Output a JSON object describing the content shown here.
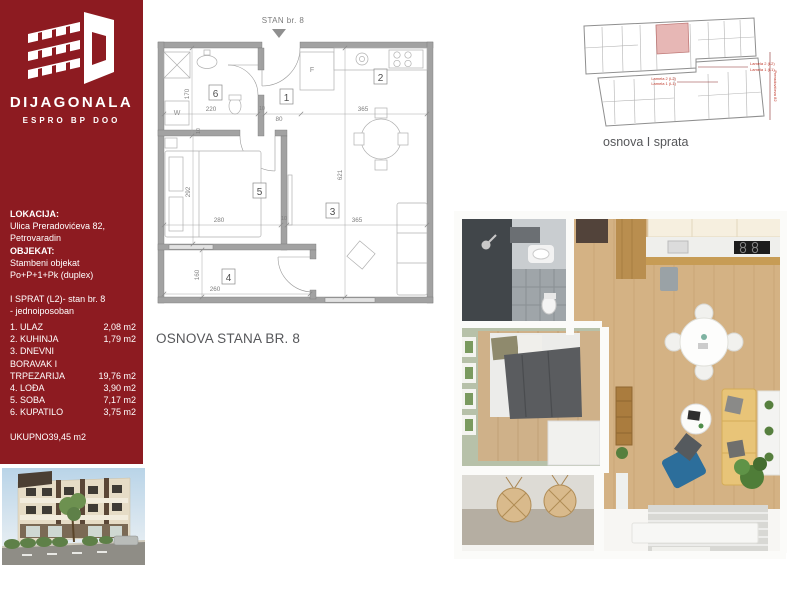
{
  "sidebar": {
    "brand": "DIJAGONALA",
    "brand_sub": "ESPRO BP DOO",
    "location_label": "LOKACIJA:",
    "location_line1": "Ulica Preradovićeva 82,",
    "location_line2": "Petrovaradin",
    "object_label": "OBJEKAT:",
    "object_line1": "Stambeni objekat",
    "object_line2": "Po+P+1+Pk (duplex)",
    "unit_line1": "I SPRAT (L2)- stan br. 8",
    "unit_line2": "- jednoiposoban",
    "rooms": [
      {
        "label": "1. ULAZ",
        "area": "2,08 m2"
      },
      {
        "label": "2. KUHINJA",
        "area": "1,79 m2"
      },
      {
        "label": "3. DNEVNI BORAVAK I TRPEZARIJA",
        "area": "19,76 m2"
      },
      {
        "label": "4. LOĐA",
        "area": "3,90 m2"
      },
      {
        "label": "5. SOBA",
        "area": "7,17 m2"
      },
      {
        "label": "6. KUPATILO",
        "area": "3,75 m2"
      }
    ],
    "total_label": "UKUPNO",
    "total_value": "39,45 m2"
  },
  "floor_plan": {
    "pointer_label": "STAN br. 8",
    "caption": "OSNOVA STANA BR. 8",
    "room_numbers": {
      "hall": "1",
      "kitchen": "2",
      "living": "3",
      "loggia": "4",
      "bedroom": "5",
      "bathroom": "6"
    },
    "fixtures": {
      "washer": "W",
      "fridge": "F"
    },
    "dims": {
      "bath_width": "220",
      "wall_a": "10",
      "entry_width": "80",
      "kitchen_width": "365",
      "bath_depth": "170",
      "bed_wall": "10",
      "bed_depth": "292",
      "bed_width": "280",
      "wall_b": "10",
      "living_width": "365",
      "apartment_depth": "621",
      "loggia_depth": "160",
      "loggia_width": "260"
    }
  },
  "site_plan": {
    "caption": "osnova I sprata",
    "label_mid1": "Lamela 2 (L2)",
    "label_mid2": "Lamela 1 (L1)",
    "label_right1": "Lamela 2 (L2)",
    "label_right2": "Lamela 1 (L1)",
    "label_street": "Preradovićeva 82"
  },
  "colors": {
    "sidebar_red": "#8d1b21",
    "highlight_pink": "#e7b7b5",
    "caption_gray": "#56575a",
    "wall_gray": "#a2a2a2"
  }
}
